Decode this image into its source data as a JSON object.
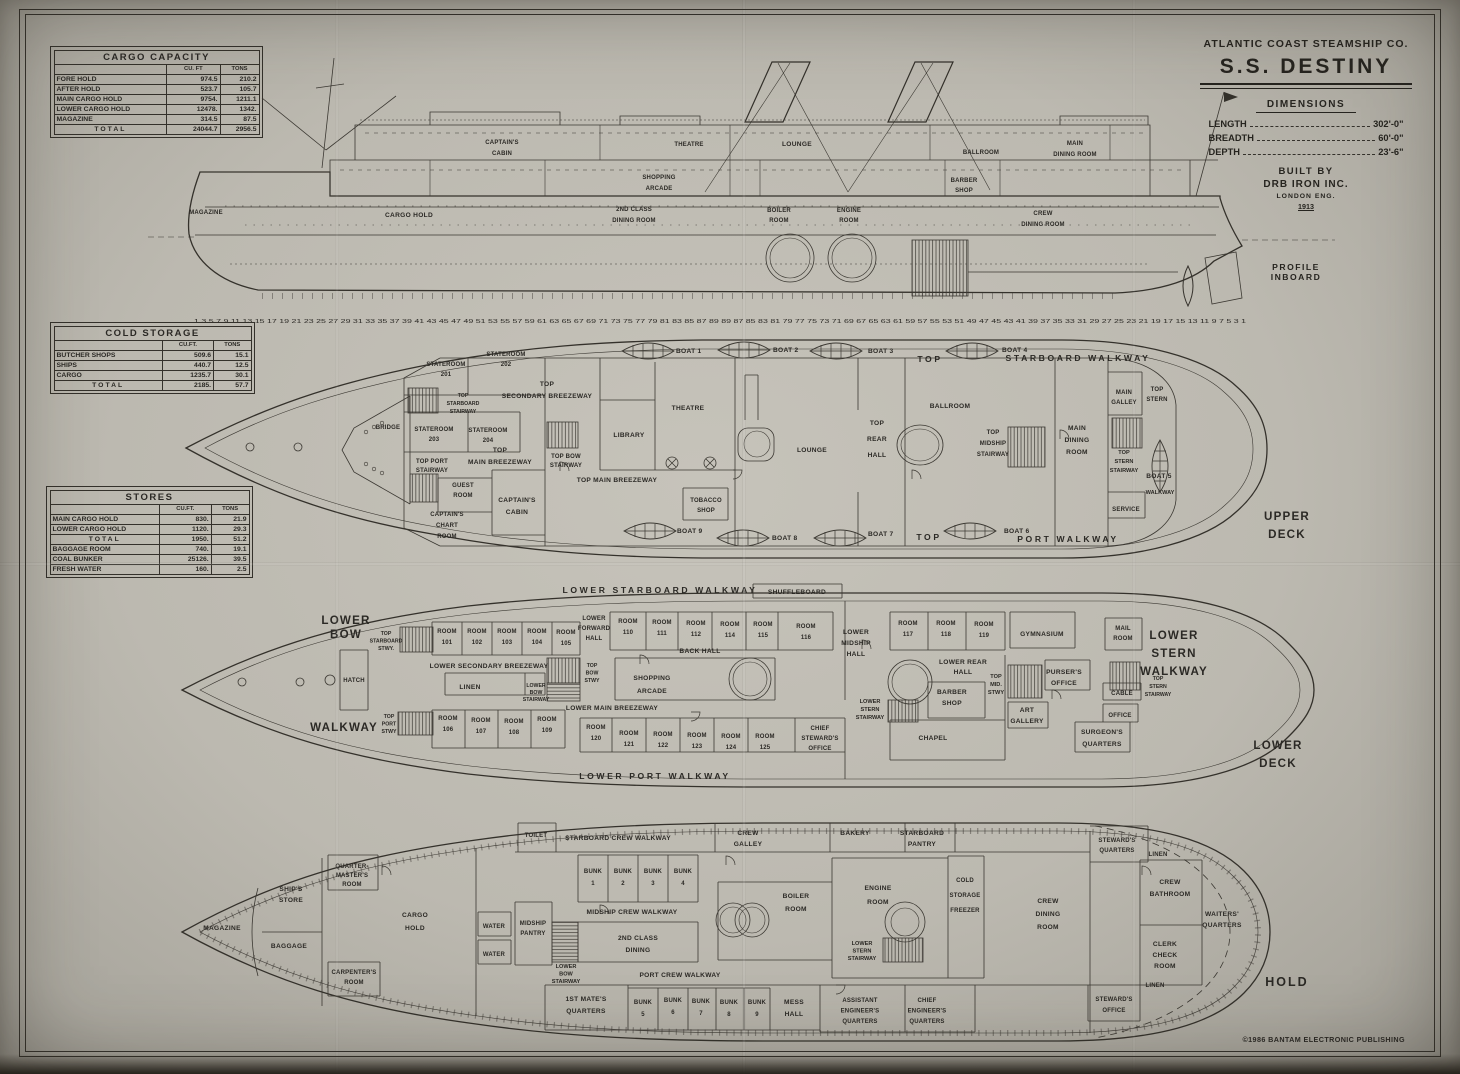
{
  "title": {
    "company": "ATLANTIC COAST STEAMSHIP CO.",
    "ship": "S.S. DESTINY",
    "dimensions": "DIMENSIONS",
    "length_label": "LENGTH",
    "length_value": "302'-0\"",
    "breadth_label": "BREADTH",
    "breadth_value": "60'-0\"",
    "depth_label": "DEPTH",
    "depth_value": "23'-6\"",
    "built_by": "BUILT BY",
    "builder": "DRB IRON INC.",
    "builder_loc": "LONDON ENG.",
    "year": "1913",
    "caption": "PROFILE\nINBOARD"
  },
  "tables": {
    "cargo": {
      "title": "CARGO CAPACITY",
      "cuft": "CU. FT",
      "tons": "TONS",
      "rows": [
        [
          "FORE HOLD",
          "974.5",
          "210.2"
        ],
        [
          "AFTER HOLD",
          "523.7",
          "105.7"
        ],
        [
          "MAIN CARGO HOLD",
          "9754.",
          "1211.1"
        ],
        [
          "LOWER CARGO HOLD",
          "12478.",
          "1342."
        ],
        [
          "MAGAZINE",
          "314.5",
          "87.5"
        ]
      ],
      "total": [
        "TOTAL",
        "24044.7",
        "2956.5"
      ]
    },
    "cold": {
      "title": "COLD  STORAGE",
      "cuft": "CU.FT.",
      "tons": "TONS",
      "rows": [
        [
          "BUTCHER SHOPS",
          "509.6",
          "15.1"
        ],
        [
          "SHIPS",
          "440.7",
          "12.5"
        ],
        [
          "CARGO",
          "1235.7",
          "30.1"
        ]
      ],
      "total": [
        "TOTAL",
        "2185.",
        "57.7"
      ]
    },
    "stores": {
      "title": "STORES",
      "cuft": "CU.FT.",
      "tons": "TONS",
      "rows_a": [
        [
          "MAIN CARGO HOLD",
          "830.",
          "21.9"
        ],
        [
          "LOWER CARGO HOLD",
          "1120.",
          "29.3"
        ]
      ],
      "total": [
        "TOTAL",
        "1950.",
        "51.2"
      ],
      "rows_b": [
        [
          "BAGGAGE ROOM",
          "740.",
          "19.1"
        ],
        [
          "COAL BUNKER",
          "25126.",
          "39.5"
        ],
        [
          "FRESH WATER",
          "160.",
          "2.5"
        ]
      ]
    }
  },
  "profile": {
    "magazine": "MAGAZINE",
    "cargo_hold": "CARGO  HOLD",
    "captains_cabin": "CAPTAIN'S\nCABIN",
    "shopping_arcade": "SHOPPING\nARCADE",
    "second_class_dining": "2ND CLASS\nDINING ROOM",
    "theatre": "THEATRE",
    "lounge": "LOUNGE",
    "boiler_room": "BOILER\nROOM",
    "engine_room": "ENGINE\nROOM",
    "ballroom": "BALLROOM",
    "barber_shop": "BARBER\nSHOP",
    "main_dining": "MAIN\nDINING ROOM",
    "crew_dining": "CREW\nDINING ROOM",
    "frame_scale": "1 3 5 7 9 11 13 15 17 19 21 23 25 27 29 31 33 35 37 39 41 43 45 47 49 51 53 55 57 59 61 63 65 67 69 71 73 75 77 79 81 83 85 87 89 89 87 85 83 81 79 77 75 73 71 69 67 65 63 61 59 57 55 53 51 49 47 45 43 41 39 37 35 33 31 29 27 25 23 21 19 17 15 13 11 9 7 5 3 1"
  },
  "upper": {
    "boat1": "BOAT 1",
    "boat2": "BOAT 2",
    "boat3": "BOAT 3",
    "boat4": "BOAT 4",
    "boat5": "BOAT 5",
    "boat6": "BOAT 6",
    "boat7": "BOAT 7",
    "boat8": "BOAT 8",
    "boat9": "BOAT 9",
    "walkway_top_1": "TOP",
    "walkway_top_2": "STARBOARD  WALKWAY",
    "walkway_bottom_1": "TOP",
    "walkway_bottom_2": "PORT  WALKWAY",
    "stateroom201": "STATEROOM\n201",
    "stateroom202": "STATEROOM\n202",
    "stateroom203": "STATEROOM\n203",
    "stateroom204": "STATEROOM\n204",
    "secondary_breezeway": "TOP\nSECONDARY  BREEZEWAY",
    "starboard_stairway": "TOP\nSTARBOARD\nSTAIRWAY",
    "bridge": "BRIDGE",
    "main_breezeway_fwd": "TOP\nMAIN  BREEZEWAY",
    "bow_stairway": "TOP  BOW\nSTAIRWAY",
    "port_stairway": "TOP PORT\nSTAIRWAY",
    "guest_room": "GUEST\nROOM",
    "captains_cabin": "CAPTAIN'S\nCABIN",
    "chart_room": "CAPTAIN'S\nCHART\nROOM",
    "library": "LIBRARY",
    "theatre": "THEATRE",
    "main_breezeway": "TOP MAIN  BREEZEWAY",
    "tobacco_shop": "TOBACCO\nSHOP",
    "lounge": "LOUNGE",
    "rear_hall": "TOP\nREAR\nHALL",
    "ballroom": "BALLROOM",
    "midship_stairway": "TOP\nMIDSHIP\nSTAIRWAY",
    "main_dining": "MAIN\nDINING\nROOM",
    "main_galley": "MAIN\nGALLEY",
    "top_stern": "TOP\nSTERN",
    "stern_stairway": "TOP\nSTERN\nSTAIRWAY",
    "walkway": "WALKWAY",
    "service": "SERVICE",
    "deck_name": "UPPER\nDECK"
  },
  "lower": {
    "walkway_top": "LOWER  STARBOARD  WALKWAY",
    "shuffleboard": "SHUFFLEBOARD",
    "lower_bow": "LOWER\nBOW",
    "bow_walkway": "WALKWAY",
    "starboard_stwy": "TOP\nSTARBOARD\nSTWY.",
    "hatch": "HATCH",
    "port_stwy": "TOP\nPORT\nSTWY",
    "room101": "ROOM\n101",
    "room102": "ROOM\n102",
    "room103": "ROOM\n103",
    "room104": "ROOM\n104",
    "room105": "ROOM\n105",
    "room106": "ROOM\n106",
    "room107": "ROOM\n107",
    "room108": "ROOM\n108",
    "room109": "ROOM\n109",
    "room110": "ROOM\n110",
    "room111": "ROOM\n111",
    "room112": "ROOM\n112",
    "room114": "ROOM\n114",
    "room115": "ROOM\n115",
    "room116": "ROOM\n116",
    "room117": "ROOM\n117",
    "room118": "ROOM\n118",
    "room119": "ROOM\n119",
    "room120": "ROOM\n120",
    "room121": "ROOM\n121",
    "room122": "ROOM\n122",
    "room123": "ROOM\n123",
    "room124": "ROOM\n124",
    "room125": "ROOM\n125",
    "secondary_breezeway": "LOWER  SECONDARY  BREEZEWAY",
    "linen": "LINEN",
    "bow_stairway": "LOWER\nBOW\nSTAIRWAY",
    "bow_stwy": "TOP\nBOW\nSTWY",
    "forward_hall": "LOWER\nFORWARD\nHALL",
    "back_hall": "BACK  HALL",
    "shopping_arcade": "SHOPPING\nARCADE",
    "main_breezeway": "LOWER MAIN  BREEZEWAY",
    "chief_stewards_office": "CHIEF\nSTEWARD'S\nOFFICE",
    "midship_hall": "LOWER\nMIDSHIP\nHALL",
    "stern_stairway": "LOWER\nSTERN\nSTAIRWAY",
    "rear_hall": "LOWER  REAR\nHALL",
    "barber_shop": "BARBER\nSHOP",
    "chapel": "CHAPEL",
    "mid_stwy": "TOP\nMID.\nSTWY",
    "gymnasium": "GYMNASIUM",
    "pursers_office": "PURSER'S\nOFFICE",
    "art_gallery": "ART\nGALLERY",
    "mail_room": "MAIL\nROOM",
    "cable": "CABLE",
    "cable_office": "OFFICE",
    "top_stern_stairway": "TOP\nSTERN\nSTAIRWAY",
    "surgeons_quarters": "SURGEON'S\nQUARTERS",
    "stern_walkway": "LOWER\nSTERN\nWALKWAY",
    "walkway_bottom": "LOWER  PORT  WALKWAY",
    "deck_name": "LOWER\nDECK"
  },
  "hold": {
    "toilet": "TOILET",
    "starboard_walkway": "STARBOARD CREW  WALKWAY",
    "crew_galley": "CREW\nGALLEY",
    "bakery": "BAKERY",
    "starboard_pantry": "STARBOARD\nPANTRY",
    "stewards_quarters_top": "STEWARD'S\nQUARTERS",
    "linen_top": "LINEN",
    "quartermasters_room": "QUARTER-\nMASTER'S\nROOM",
    "ships_store": "SHIP'S\nSTORE",
    "bunk1": "BUNK\n1",
    "bunk2": "BUNK\n2",
    "bunk3": "BUNK\n3",
    "bunk4": "BUNK\n4",
    "bunk5": "BUNK\n5",
    "bunk6": "BUNK\n6",
    "bunk7": "BUNK\n7",
    "bunk8": "BUNK\n8",
    "bunk9": "BUNK\n9",
    "crew_bathroom": "CREW\nBATHROOM",
    "magazine": "MAGAZINE",
    "baggage": "BAGGAGE",
    "cargo_hold": "CARGO\nHOLD",
    "water1": "WATER",
    "water2": "WATER",
    "midship_pantry": "MIDSHIP\nPANTRY",
    "midship_walkway": "MIDSHIP CREW  WALKWAY",
    "second_class_dining": "2ND  CLASS\nDINING",
    "boiler_room": "BOILER\nROOM",
    "engine_room": "ENGINE\nROOM",
    "cold_storage": "COLD\nSTORAGE\nFREEZER",
    "crew_dining": "CREW\nDINING\nROOM",
    "waiters_quarters": "WAITERS'\nQUARTERS",
    "stern_stairway": "LOWER\nSTERN\nSTAIRWAY",
    "clerk_check": "CLERK\nCHECK\nROOM",
    "carpenters_room": "CARPENTER'S\nROOM",
    "bow_stairway": "LOWER\nBOW\nSTAIRWAY",
    "port_walkway": "PORT  CREW  WALKWAY",
    "first_mate": "1ST MATE'S\nQUARTERS",
    "mess_hall": "MESS\nHALL",
    "asst_engineer": "ASSISTANT\nENGINEER'S\nQUARTERS",
    "chief_engineer": "CHIEF\nENGINEER'S\nQUARTERS",
    "stewards_quarters_bot": "STEWARD'S\nQUARTERS",
    "linen_bot": "LINEN",
    "stewards_office": "STEWARD'S\nOFFICE",
    "name": "HOLD"
  },
  "copyright": "©1986 BANTAM ELECTRONIC PUBLISHING"
}
